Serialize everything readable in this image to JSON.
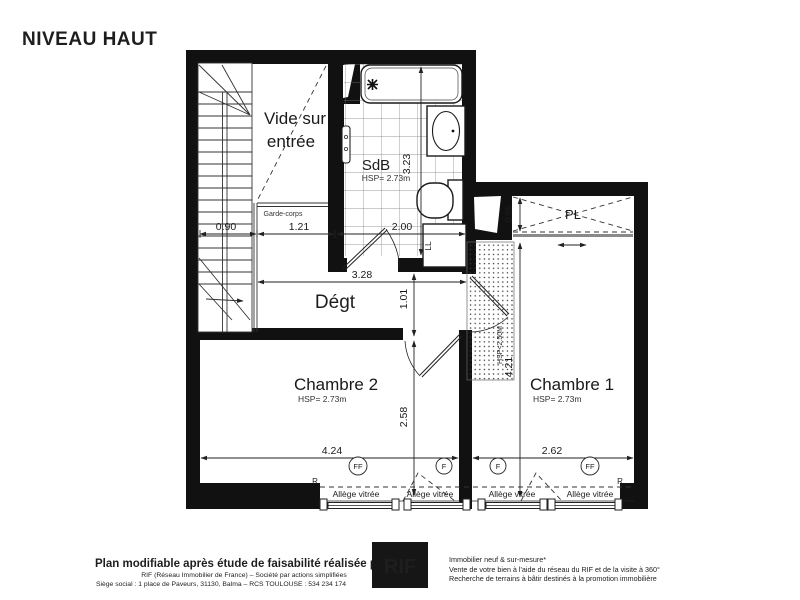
{
  "plan": {
    "title": "NIVEAU HAUT",
    "vide_line1": "Vide sur",
    "vide_line2": "entrée",
    "garde_corps": "Garde-corps",
    "sdb": "SdB",
    "sdb_hsp": "HSP= 2.73m",
    "degt": "Dégt",
    "chambre2": "Chambre 2",
    "chambre2_hsp": "HSP= 2.73m",
    "chambre1": "Chambre 1",
    "chambre1_hsp": "HSP= 2.73m",
    "pl": "PL",
    "ll": "LL",
    "low_ceiling": "HSP<2.50M",
    "r_left": "R",
    "r_right": "R",
    "allege_vitree": "Allège vitrée",
    "window_code_ff": "FF",
    "window_code_f": "F",
    "dims": {
      "d090": "0.90",
      "d121": "1.21",
      "d200": "2.00",
      "d323v": "3.23",
      "d328": "3.28",
      "d101": "1.01",
      "d258": "2.58",
      "d424": "4.24",
      "d262": "2.62",
      "d421": "4.21",
      "d065": "0.65"
    }
  },
  "footer": {
    "disclaimer": "Plan modifiable après étude de faisabilité réalisée par le RIF",
    "company_line1": "RIF (Réseau Immobilier de France) – Société par actions simplifiées",
    "company_line2": "Siège social : 1 place de Paveurs, 31130, Balma – RCS TOULOUSE : 534 234 174",
    "logo": "RIF",
    "services": [
      "Immobilier neuf & sur-mesure*",
      "Vente de votre bien à l'aide du réseau du RIF et de la visite à 360°",
      "Recherche de terrains à bâtir destinés à la promotion immobilière"
    ]
  },
  "colors": {
    "line": "#111111",
    "logo_bg": "#161616",
    "muted": "#a9a9a9",
    "track_gray": "#8a8a8a"
  }
}
